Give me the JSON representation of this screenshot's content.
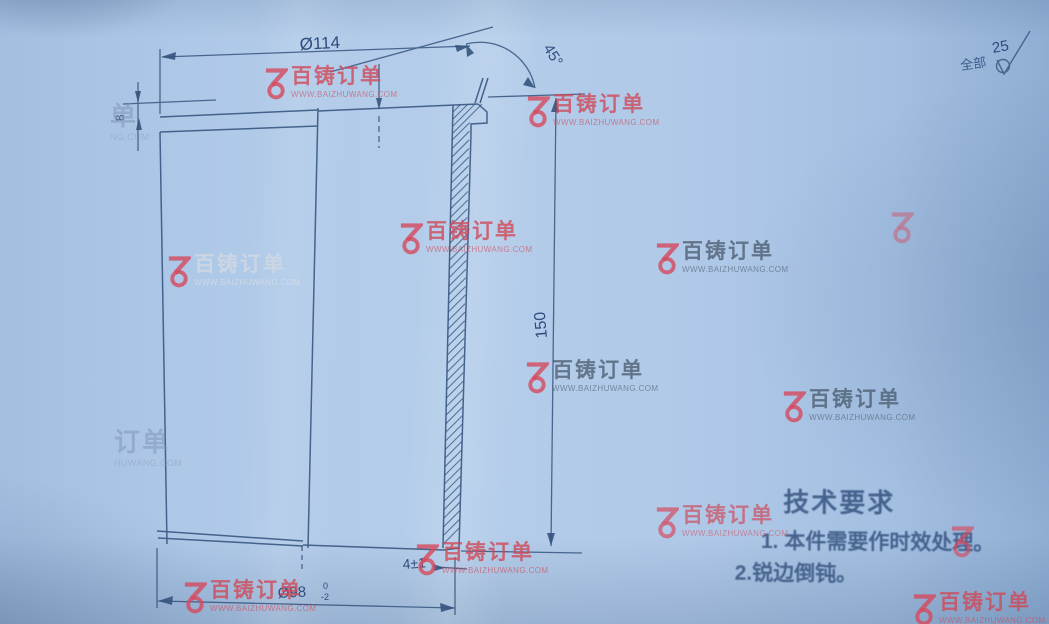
{
  "part_drawing": {
    "dimensions": {
      "top_diameter": "Ø114",
      "chamfer_angle": "45°",
      "length": "150",
      "bottom_step": "4±1",
      "bottom_diameter": "Ø98",
      "bottom_tol_upper": "0",
      "bottom_tol_lower": "-2",
      "top_step_depth": "8"
    },
    "surface_finish": {
      "scope": "全部",
      "roughness": "25"
    },
    "tech": {
      "title": "技术要求",
      "items": [
        "1. 本件需要作时效处理。",
        "2.锐边倒钝。"
      ]
    }
  },
  "watermark": {
    "brand": "百铸订单",
    "url": "WWW.BAIZHUWANG.COM",
    "instances": [
      {
        "x": 263,
        "y": 66,
        "variant": "red"
      },
      {
        "x": 525,
        "y": 94,
        "variant": "red"
      },
      {
        "x": 889,
        "y": 210,
        "variant": "logo-only",
        "opacity": 0.55
      },
      {
        "x": 398,
        "y": 221,
        "variant": "red"
      },
      {
        "x": 654,
        "y": 241,
        "variant": "gray"
      },
      {
        "x": 166,
        "y": 254,
        "variant": "lightgray"
      },
      {
        "x": 524,
        "y": 360,
        "variant": "gray"
      },
      {
        "x": 781,
        "y": 389,
        "variant": "gray"
      },
      {
        "x": 114,
        "y": 429,
        "variant": "faint",
        "logo": false,
        "text": "订单",
        "url": "HUWANG.COM"
      },
      {
        "x": 654,
        "y": 505,
        "variant": "red",
        "opacity": 0.85
      },
      {
        "x": 949,
        "y": 524,
        "variant": "logo-only",
        "opacity": 0.8
      },
      {
        "x": 414,
        "y": 542,
        "variant": "red"
      },
      {
        "x": 182,
        "y": 580,
        "variant": "red"
      },
      {
        "x": 911,
        "y": 592,
        "variant": "red"
      },
      {
        "x": 110,
        "y": 103,
        "variant": "faint",
        "logo": false,
        "text": "单",
        "url": "NG.COM"
      }
    ]
  }
}
